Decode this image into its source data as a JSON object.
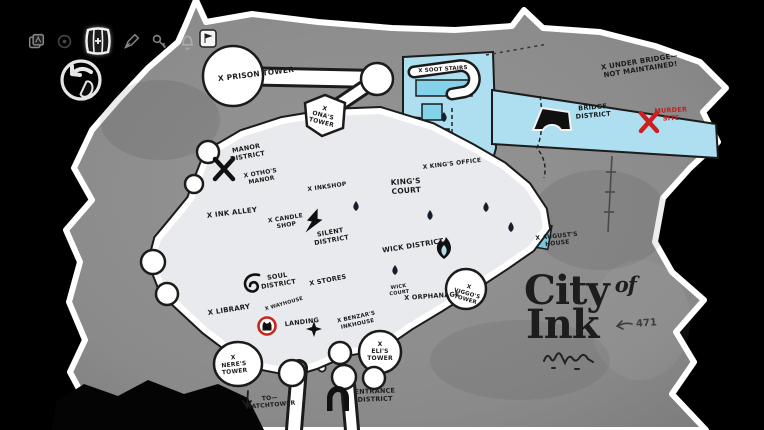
{
  "screen": {
    "name": "City of Ink map screen",
    "game_view": "world map"
  },
  "palette": {
    "background": "#000000",
    "island_gray": "#8c8c8c",
    "outline_white": "#ffffff",
    "ink_black": "#1b1b1b",
    "bridge_blue": "#addff0",
    "wick_teal": "#b7dfe3",
    "silent_lavender": "#c9c6dd",
    "manor_blue": "#bcc7d9",
    "soul_blue": "#95a1c0",
    "alert_red": "#cc1f1f"
  },
  "toolbar": {
    "icons": [
      {
        "name": "journal-icon",
        "selected": false
      },
      {
        "name": "compass-icon",
        "selected": false
      },
      {
        "name": "map-icon",
        "selected": true
      },
      {
        "name": "pen-icon",
        "selected": false
      },
      {
        "name": "key-icon",
        "selected": false
      },
      {
        "name": "bell-icon",
        "selected": false
      }
    ],
    "back": {
      "icon": "back-arrow-icon",
      "hint_icon": "mouse-right-click-icon"
    }
  },
  "map": {
    "title": {
      "line1": "City",
      "of": "of",
      "line2": "Ink"
    },
    "annotation": "471",
    "districts": [
      {
        "name": "Manor District",
        "color": "#bcc7d9"
      },
      {
        "name": "Silent District",
        "color": "#c9c6dd"
      },
      {
        "name": "King's Court",
        "color": "#d6d3e6"
      },
      {
        "name": "Soul District",
        "color": "#95a1c0"
      },
      {
        "name": "Wick District",
        "color": "#b7dfe3"
      },
      {
        "name": "Bridge District",
        "color": "#addff0"
      },
      {
        "name": "Entrance District",
        "color": "#8c8c8c"
      }
    ],
    "markers": [
      {
        "name": "player-location-marker",
        "at": "Landing",
        "color": "#cc1f1f"
      },
      {
        "name": "murder-site-x-marker",
        "color": "#cc1f1f"
      },
      {
        "name": "prison-tower-stamp-badge"
      },
      {
        "name": "wick-flame-icon"
      },
      {
        "name": "silent-bolt-icon"
      },
      {
        "name": "soul-spiral-icon"
      },
      {
        "name": "entrance-arch-icon"
      },
      {
        "name": "bridge-glyph-icon"
      },
      {
        "name": "manor-x-landmark-icon"
      },
      {
        "name": "sparkle-icon"
      },
      {
        "name": "ink-drop-marker",
        "count": 6
      },
      {
        "name": "to-watchtower-arrow-icon"
      },
      {
        "name": "signature-scribble"
      }
    ],
    "labels": [
      {
        "id": "prison-tower",
        "text": "X Prison Tower",
        "x": 256,
        "y": 74,
        "rot": -7,
        "size": 7.5
      },
      {
        "id": "onas-tower",
        "text": "X\nOna's\nTower",
        "x": 323,
        "y": 116,
        "rot": 14,
        "size": 6
      },
      {
        "id": "manor-district",
        "text": "Manor\nDistrict",
        "x": 247,
        "y": 153,
        "rot": -10,
        "size": 6.5
      },
      {
        "id": "othos-manor",
        "text": "X Otho's\nManor",
        "x": 261,
        "y": 177,
        "rot": -10,
        "size": 6
      },
      {
        "id": "ink-alley",
        "text": "X Ink Alley",
        "x": 232,
        "y": 213,
        "rot": -7,
        "size": 7
      },
      {
        "id": "candle-shop",
        "text": "X Candle\nShop",
        "x": 286,
        "y": 222,
        "rot": -9,
        "size": 6
      },
      {
        "id": "inkshop",
        "text": "X Inkshop",
        "x": 327,
        "y": 187,
        "rot": -8,
        "size": 6
      },
      {
        "id": "kings-court",
        "text": "King's\nCourt",
        "x": 406,
        "y": 186,
        "rot": -4,
        "size": 7.5
      },
      {
        "id": "kings-office",
        "text": "X King's Office",
        "x": 452,
        "y": 164,
        "rot": -7,
        "size": 6
      },
      {
        "id": "silent-district",
        "text": "Silent\nDistrict",
        "x": 331,
        "y": 237,
        "rot": -10,
        "size": 6.5
      },
      {
        "id": "wick-district",
        "text": "Wick District",
        "x": 413,
        "y": 246,
        "rot": -9,
        "size": 7
      },
      {
        "id": "stores",
        "text": "X Stores",
        "x": 328,
        "y": 281,
        "rot": -11,
        "size": 6.5
      },
      {
        "id": "wick-court",
        "text": "Wick\nCourt",
        "x": 399,
        "y": 290,
        "rot": -8,
        "size": 5
      },
      {
        "id": "orphanage",
        "text": "X Orphanage",
        "x": 432,
        "y": 297,
        "rot": -4,
        "size": 6.5
      },
      {
        "id": "viggos-tower",
        "text": "X\nViggo's\nTower",
        "x": 467,
        "y": 294,
        "rot": 16,
        "size": 5.5
      },
      {
        "id": "augusts-house",
        "text": "X August's\nHouse",
        "x": 557,
        "y": 240,
        "rot": -6,
        "size": 6
      },
      {
        "id": "soul-district",
        "text": "Soul\nDistrict",
        "x": 278,
        "y": 281,
        "rot": -9,
        "size": 6.5
      },
      {
        "id": "library",
        "text": "X Library",
        "x": 229,
        "y": 310,
        "rot": -9,
        "size": 7
      },
      {
        "id": "wayhouse",
        "text": "X Wayhouse",
        "x": 284,
        "y": 304,
        "rot": -16,
        "size": 5
      },
      {
        "id": "landing",
        "text": "Landing",
        "x": 302,
        "y": 323,
        "rot": -7,
        "size": 6.5
      },
      {
        "id": "benzars-inkhouse",
        "text": "X Benzar's\nInkhouse",
        "x": 357,
        "y": 321,
        "rot": -12,
        "size": 5.5
      },
      {
        "id": "elis-tower",
        "text": "X\nEli's\nTower",
        "x": 380,
        "y": 352,
        "rot": 0,
        "size": 6
      },
      {
        "id": "neres-tower",
        "text": "X\nNere's\nTower",
        "x": 234,
        "y": 365,
        "rot": -6,
        "size": 6
      },
      {
        "id": "to-watchtower",
        "text": "To—\nWatchtower",
        "x": 270,
        "y": 402,
        "rot": -5,
        "size": 6
      },
      {
        "id": "entrance-district",
        "text": "Entrance\nDistrict",
        "x": 375,
        "y": 396,
        "rot": -2,
        "size": 6.5
      },
      {
        "id": "soot-stairs",
        "text": "X Soot Stairs",
        "x": 443,
        "y": 70,
        "rot": -4,
        "size": 5.5
      },
      {
        "id": "under-bridge",
        "text": "X Under Bridge—\nNot Maintained!",
        "x": 640,
        "y": 66,
        "rot": -9,
        "size": 7
      },
      {
        "id": "bridge-district",
        "text": "Bridge\nDistrict",
        "x": 593,
        "y": 112,
        "rot": -5,
        "size": 6.5
      },
      {
        "id": "murder-site",
        "text": "Murder\nSite",
        "x": 671,
        "y": 115,
        "rot": -3,
        "size": 6.5,
        "color": "#c41f1f"
      }
    ]
  }
}
